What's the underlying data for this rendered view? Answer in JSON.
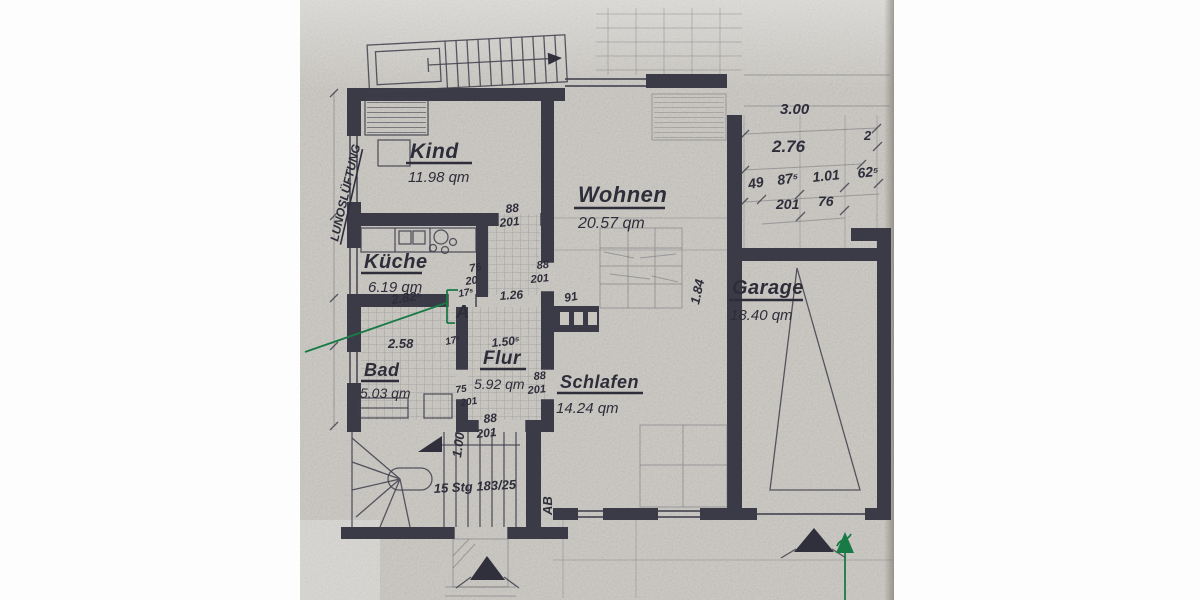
{
  "document": {
    "kind": "scanned floor plan",
    "language": "de"
  },
  "rooms": {
    "kind": {
      "name": "Kind",
      "area": "11.98 qm"
    },
    "wohnen": {
      "name": "Wohnen",
      "area": "20.57 qm"
    },
    "kueche": {
      "name": "Küche",
      "area": "6.19 qm"
    },
    "bad": {
      "name": "Bad",
      "area": "5.03 qm"
    },
    "flur": {
      "name": "Flur",
      "area": "5.92 qm"
    },
    "schlafen": {
      "name": "Schlafen",
      "area": "14.24 qm"
    },
    "garage": {
      "name": "Garage",
      "area": "18.40 qm"
    }
  },
  "dims": {
    "d300": "3.00",
    "d276": "2.76",
    "d2": "2",
    "d49": "49",
    "d875": "87⁵",
    "d101": "1.01",
    "d625": "62⁵",
    "d201": "201",
    "d76": "76",
    "d126": "1.26",
    "d91": "91",
    "d1505": "1.50⁵",
    "d2825": "2.82⁵",
    "d258": "2.58",
    "d175a": "17⁵",
    "d175b": "17⁵",
    "d184": "1.84",
    "d100": "1.00",
    "win76": "76",
    "win20": "20"
  },
  "doors": {
    "kind": {
      "w": "88",
      "h": "201"
    },
    "wohnen": {
      "w": "88",
      "h": "201"
    },
    "schlafen": {
      "w": "88",
      "h": "201"
    },
    "flur": {
      "w": "88",
      "h": "201"
    },
    "bad": {
      "w": "75",
      "h": "201"
    }
  },
  "stairs": {
    "winder_label": "15 Stg 183/25"
  },
  "labels": {
    "ab": "AB",
    "lunos": "LUNOSLÜFTUNG"
  },
  "annotations": {
    "a_marker": "A"
  },
  "colors": {
    "ink": "#3b3b48",
    "pencil": "#5a5a64",
    "green_pen": "#187a45",
    "paper": "#c9c6c0"
  }
}
